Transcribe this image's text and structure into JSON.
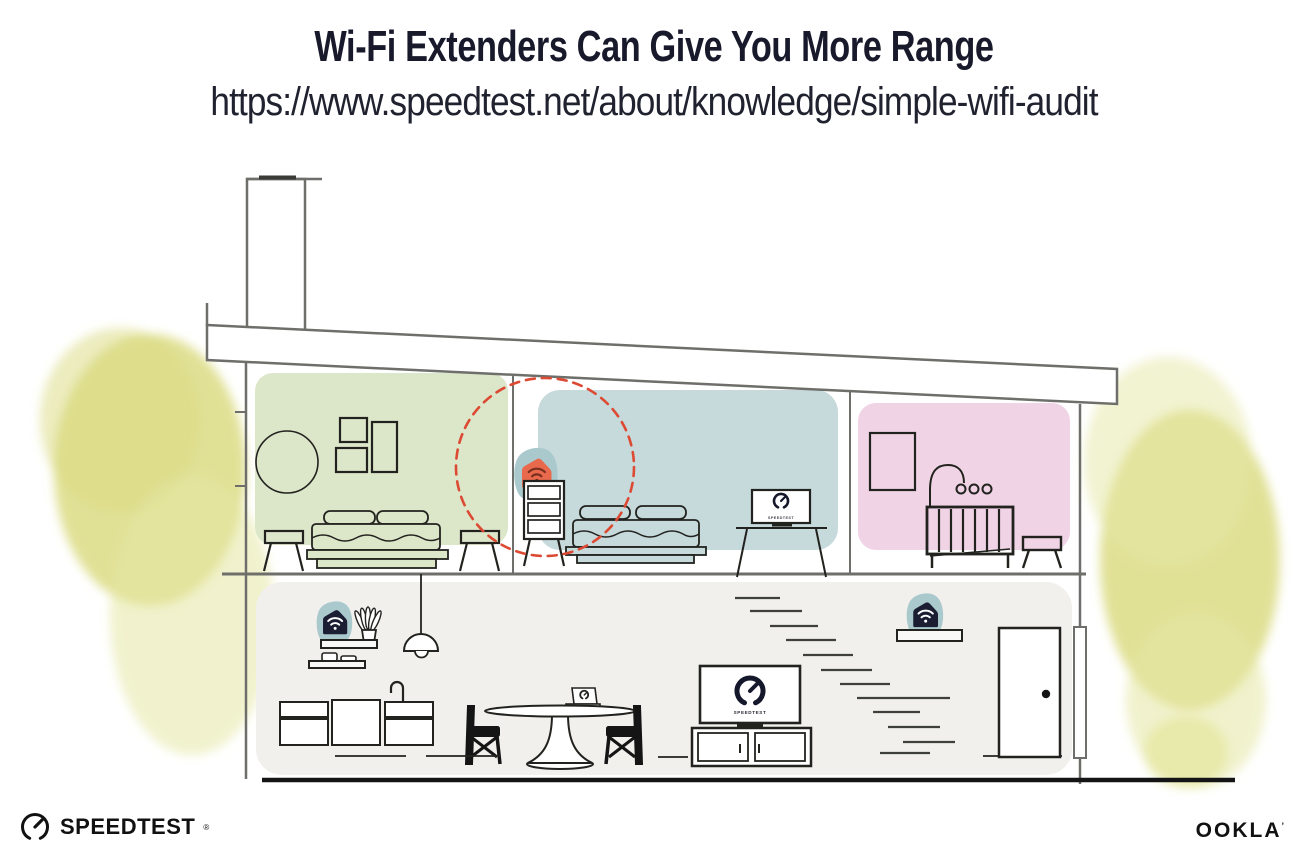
{
  "header": {
    "title": "Wi-Fi Extenders Can Give You More Range",
    "url": "https://www.speedtest.net/about/knowledge/simple-wifi-audit"
  },
  "house": {
    "bedroom_tv_label": "SPEEDTEST",
    "living_tv_label": "SPEEDTEST",
    "floors": [
      {
        "name": "upper-floor",
        "rooms": [
          {
            "name": "bedroom-left",
            "wall_color": "#dce6c9",
            "furniture": [
              "round-mirror",
              "picture-frame-small",
              "picture-frame-small",
              "picture-frame-tall",
              "double-bed",
              "stool-left",
              "stool-right"
            ]
          },
          {
            "name": "bedroom-middle",
            "wall_color": "#c6d9db",
            "furniture": [
              "dresser",
              "double-bed",
              "tv-on-stand"
            ],
            "devices": [
              "wifi-extender-highlighted"
            ],
            "highlight": "red-dashed-range-circle"
          },
          {
            "name": "nursery",
            "wall_color": "#f0d4e6",
            "furniture": [
              "picture-frame",
              "crib-with-mobile",
              "stool"
            ]
          }
        ]
      },
      {
        "name": "lower-floor",
        "rooms": [
          {
            "name": "living-area",
            "wall_color": "#f1f0ed",
            "furniture": [
              "wall-shelf-upper",
              "wall-shelf-lower",
              "plant",
              "cups",
              "pendant-lamp",
              "kitchen-cabinets",
              "faucet",
              "dining-table",
              "laptop",
              "chair-left",
              "chair-right",
              "tv",
              "media-console",
              "staircase",
              "entry-shelf",
              "front-door"
            ],
            "devices": [
              "wifi-router",
              "wifi-extender-entry"
            ]
          }
        ]
      }
    ],
    "devices": [
      {
        "name": "wifi-router",
        "location": "living-room-shelf",
        "body_color": "#1b1d32",
        "halo_color": "#a9c9cd",
        "icon": "wifi-icon"
      },
      {
        "name": "wifi-extender",
        "location": "bedroom-dresser",
        "body_color": "#e8694b",
        "halo_color": "#a9c9cd",
        "icon": "wifi-icon",
        "highlighted": true
      },
      {
        "name": "wifi-extender",
        "location": "entry-shelf",
        "body_color": "#1b1d32",
        "halo_color": "#a9c9cd",
        "icon": "wifi-icon"
      }
    ],
    "colors": {
      "accent_orange": "#e8694b",
      "device_navy": "#1b1d32",
      "teal_halo": "#a9c9cd",
      "range_circle_red": "#dd4a33",
      "room_green": "#dce6c9",
      "room_blue": "#c6d9db",
      "room_pink": "#f0d4e6",
      "floor_gray": "#f1f0ed",
      "foliage_yellow": "#dfe08d",
      "structure_gray": "#6e6e6a",
      "ink": "#191b2e"
    }
  },
  "footer": {
    "speedtest_label": "SPEEDTEST",
    "speedtest_mark": "®",
    "ookla_label": "OOKLA",
    "ookla_mark": "’"
  }
}
